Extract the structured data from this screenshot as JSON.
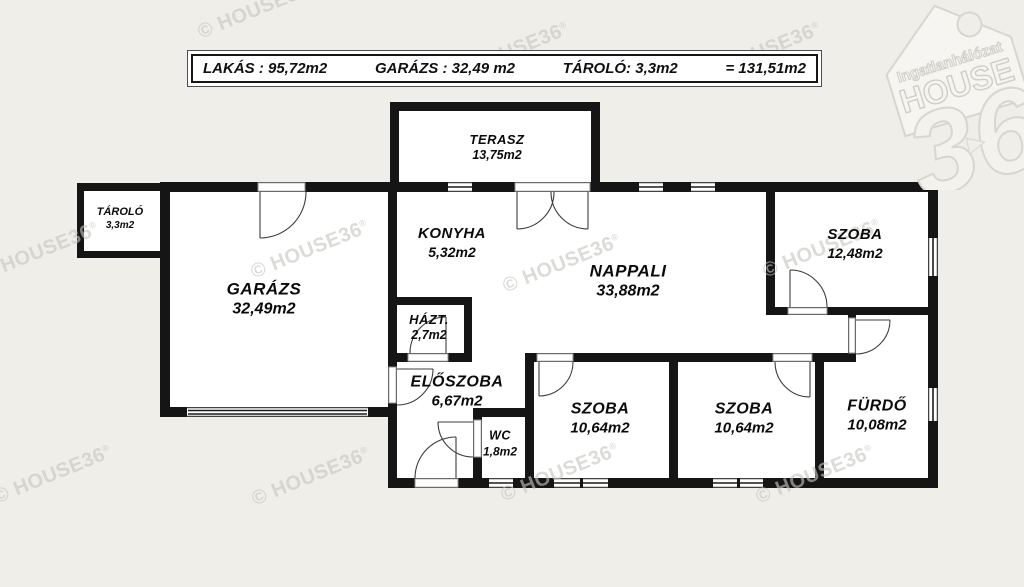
{
  "header": {
    "items": [
      "LAKÁS : 95,72m2",
      "GARÁZS : 32,49 m2",
      "TÁROLÓ: 3,3m2",
      "= 131,51m2"
    ]
  },
  "rooms": {
    "terasz": {
      "name": "TERASZ",
      "area": "13,75m2"
    },
    "konyha": {
      "name": "KONYHA",
      "area": "5,32m2"
    },
    "nappali": {
      "name": "NAPPALI",
      "area": "33,88m2"
    },
    "garazs": {
      "name": "GARÁZS",
      "area": "32,49m2"
    },
    "tarolo": {
      "name": "TÁROLÓ",
      "area": "3,3m2"
    },
    "hazt": {
      "name": "HÁZT.",
      "area": "2,7m2"
    },
    "eloszoba": {
      "name": "ELŐSZOBA",
      "area": "6,67m2"
    },
    "wc": {
      "name": "WC",
      "area": "1,8m2"
    },
    "szoba1": {
      "name": "SZOBA",
      "area": "10,64m2"
    },
    "szoba2": {
      "name": "SZOBA",
      "area": "10,64m2"
    },
    "szoba3": {
      "name": "SZOBA",
      "area": "12,48m2"
    },
    "furdo": {
      "name": "FÜRDŐ",
      "area": "10,08m2"
    }
  },
  "watermark": {
    "text": "© HOUSE36",
    "mark": "®"
  },
  "logo": {
    "line1": "Ingatlanhálózat",
    "line2": "HOUSE",
    "line3": "36"
  },
  "colors": {
    "background": "#efeee9",
    "wall": "#151515",
    "paper": "#ffffff",
    "watermark": "#c7c6c0",
    "text": "#0b0b0b"
  }
}
